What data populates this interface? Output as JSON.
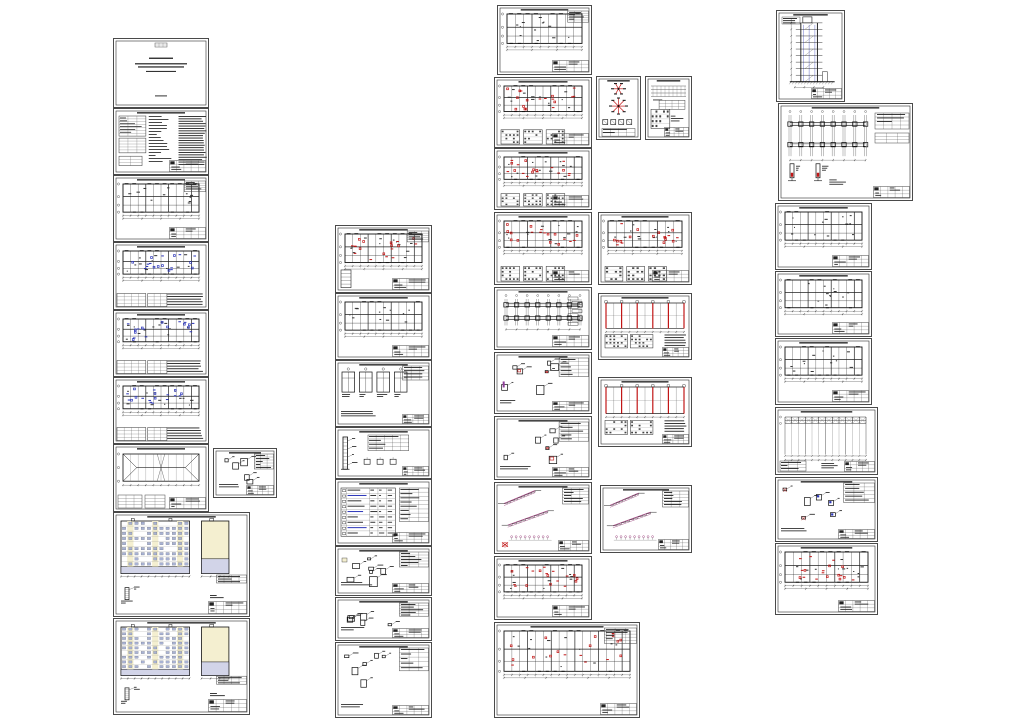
{
  "canvas": {
    "width": 1024,
    "height": 724,
    "background": "#ffffff"
  },
  "palette": {
    "paper": "#ffffff",
    "frame": "#4a4a4a",
    "ink": "#1a1a1a",
    "accent_blue": "#2b35b8",
    "accent_red": "#c11616",
    "accent_purple": "#8f3f9a",
    "accent_magenta": "#a34f86",
    "facade_yellow": "#f4efd0",
    "facade_lavender": "#d2d4e8",
    "window_blue": "#a8b2d4"
  },
  "sheets": [
    {
      "name": "cover-title-sheet",
      "kind": "title-page",
      "x": 113,
      "y": 38,
      "w": 96,
      "h": 70
    },
    {
      "name": "general-notes-sheet",
      "kind": "notes",
      "x": 113,
      "y": 108,
      "w": 96,
      "h": 67
    },
    {
      "name": "floor-plan-level-1",
      "kind": "plan",
      "x": 113,
      "y": 175,
      "w": 96,
      "h": 67,
      "legend": true
    },
    {
      "name": "floor-plan-typical-a",
      "kind": "plan",
      "x": 113,
      "y": 242,
      "w": 96,
      "h": 68,
      "accent": "blue",
      "bottomTable": true
    },
    {
      "name": "floor-plan-typical-b",
      "kind": "plan",
      "x": 113,
      "y": 310,
      "w": 96,
      "h": 67,
      "accent": "blue",
      "bottomTable": true
    },
    {
      "name": "floor-plan-typical-c",
      "kind": "plan",
      "x": 113,
      "y": 377,
      "w": 96,
      "h": 67,
      "accent": "blue",
      "bottomTable": true
    },
    {
      "name": "roof-basement-plan",
      "kind": "roof-plan",
      "x": 113,
      "y": 444,
      "w": 96,
      "h": 68
    },
    {
      "name": "small-detail-sheet",
      "kind": "details",
      "x": 213,
      "y": 448,
      "w": 64,
      "h": 50
    },
    {
      "name": "facade-elevation-1",
      "kind": "elevation",
      "x": 113,
      "y": 512,
      "w": 137,
      "h": 105
    },
    {
      "name": "facade-elevation-2",
      "kind": "elevation",
      "x": 113,
      "y": 618,
      "w": 137,
      "h": 97
    },
    {
      "name": "structural-plan-marked",
      "kind": "plan",
      "x": 335,
      "y": 225,
      "w": 97,
      "h": 68,
      "accent": "red",
      "legend": true,
      "miniSection": true
    },
    {
      "name": "structural-plan",
      "kind": "plan",
      "x": 335,
      "y": 293,
      "w": 97,
      "h": 67
    },
    {
      "name": "window-details-sheet",
      "kind": "details",
      "x": 335,
      "y": 360,
      "w": 97,
      "h": 67,
      "variant": "windows"
    },
    {
      "name": "vertical-detail-sheet",
      "kind": "details",
      "x": 335,
      "y": 427,
      "w": 97,
      "h": 52,
      "variant": "vert"
    },
    {
      "name": "schedule-sheet",
      "kind": "schedule",
      "x": 335,
      "y": 479,
      "w": 97,
      "h": 67
    },
    {
      "name": "node-details-a",
      "kind": "details",
      "x": 335,
      "y": 546,
      "w": 97,
      "h": 50,
      "yellow": true
    },
    {
      "name": "node-details-b",
      "kind": "details",
      "x": 335,
      "y": 597,
      "w": 97,
      "h": 44
    },
    {
      "name": "node-details-c",
      "kind": "details",
      "x": 335,
      "y": 642,
      "w": 97,
      "h": 76
    },
    {
      "name": "slab-layout-plan-top",
      "kind": "plan",
      "x": 497,
      "y": 5,
      "w": 95,
      "h": 70,
      "legend": true
    },
    {
      "name": "slab-layout-plan-2",
      "kind": "plan",
      "x": 494,
      "y": 77,
      "w": 98,
      "h": 71,
      "accent": "red",
      "facadeRow": true
    },
    {
      "name": "slab-layout-plan-3",
      "kind": "plan",
      "x": 494,
      "y": 148,
      "w": 98,
      "h": 62,
      "accent": "red",
      "facadeRow": true
    },
    {
      "name": "slab-layout-plan-4",
      "kind": "plan",
      "x": 494,
      "y": 212,
      "w": 98,
      "h": 73,
      "accent": "red",
      "facadeRow": true
    },
    {
      "name": "foundation-layout",
      "kind": "foundation",
      "x": 494,
      "y": 287,
      "w": 98,
      "h": 63
    },
    {
      "name": "element-details-marked",
      "kind": "details",
      "x": 494,
      "y": 352,
      "w": 98,
      "h": 62,
      "accent2": "red",
      "purple": true
    },
    {
      "name": "element-details-2",
      "kind": "details",
      "x": 494,
      "y": 416,
      "w": 98,
      "h": 64,
      "accent2": "red"
    },
    {
      "name": "stair-flight-details-1",
      "kind": "stairs",
      "x": 494,
      "y": 482,
      "w": 98,
      "h": 72,
      "redmark": true
    },
    {
      "name": "marked-plan-lower",
      "kind": "plan",
      "x": 494,
      "y": 556,
      "w": 98,
      "h": 64,
      "accent": "red"
    },
    {
      "name": "marked-plan-bottom-wide",
      "kind": "plan",
      "x": 494,
      "y": 622,
      "w": 146,
      "h": 96,
      "accent": "red",
      "legend": true
    },
    {
      "name": "roof-node-symbols",
      "kind": "symbols",
      "x": 596,
      "y": 76,
      "w": 45,
      "h": 64
    },
    {
      "name": "framing-elevation-sheet",
      "kind": "frame-elev",
      "x": 645,
      "y": 76,
      "w": 47,
      "h": 64
    },
    {
      "name": "slab-layout-plan-right",
      "kind": "plan",
      "x": 598,
      "y": 212,
      "w": 94,
      "h": 73,
      "accent": "red",
      "facadeRow": true
    },
    {
      "name": "frame-section-red-1",
      "kind": "frame-red",
      "x": 598,
      "y": 293,
      "w": 94,
      "h": 67
    },
    {
      "name": "frame-section-red-2",
      "kind": "frame-red",
      "x": 598,
      "y": 377,
      "w": 94,
      "h": 70
    },
    {
      "name": "stair-flight-details-2",
      "kind": "stairs",
      "x": 600,
      "y": 485,
      "w": 92,
      "h": 68
    },
    {
      "name": "building-cross-section",
      "kind": "section",
      "x": 776,
      "y": 10,
      "w": 69,
      "h": 92
    },
    {
      "name": "foundation-plan-wide",
      "kind": "foundation",
      "x": 778,
      "y": 103,
      "w": 135,
      "h": 98,
      "wide": true
    },
    {
      "name": "wall-plan-a",
      "kind": "plan",
      "x": 775,
      "y": 203,
      "w": 97,
      "h": 67
    },
    {
      "name": "wall-plan-b",
      "kind": "plan",
      "x": 775,
      "y": 271,
      "w": 97,
      "h": 66
    },
    {
      "name": "wall-plan-c",
      "kind": "plan",
      "x": 775,
      "y": 338,
      "w": 97,
      "h": 67
    },
    {
      "name": "roof-framing-plan",
      "kind": "truss",
      "x": 775,
      "y": 407,
      "w": 103,
      "h": 68
    },
    {
      "name": "anchor-details-sheet",
      "kind": "details",
      "x": 775,
      "y": 477,
      "w": 103,
      "h": 65,
      "accent2": "mixed"
    },
    {
      "name": "marked-wall-plan",
      "kind": "plan",
      "x": 775,
      "y": 543,
      "w": 103,
      "h": 72,
      "accent": "red"
    }
  ]
}
